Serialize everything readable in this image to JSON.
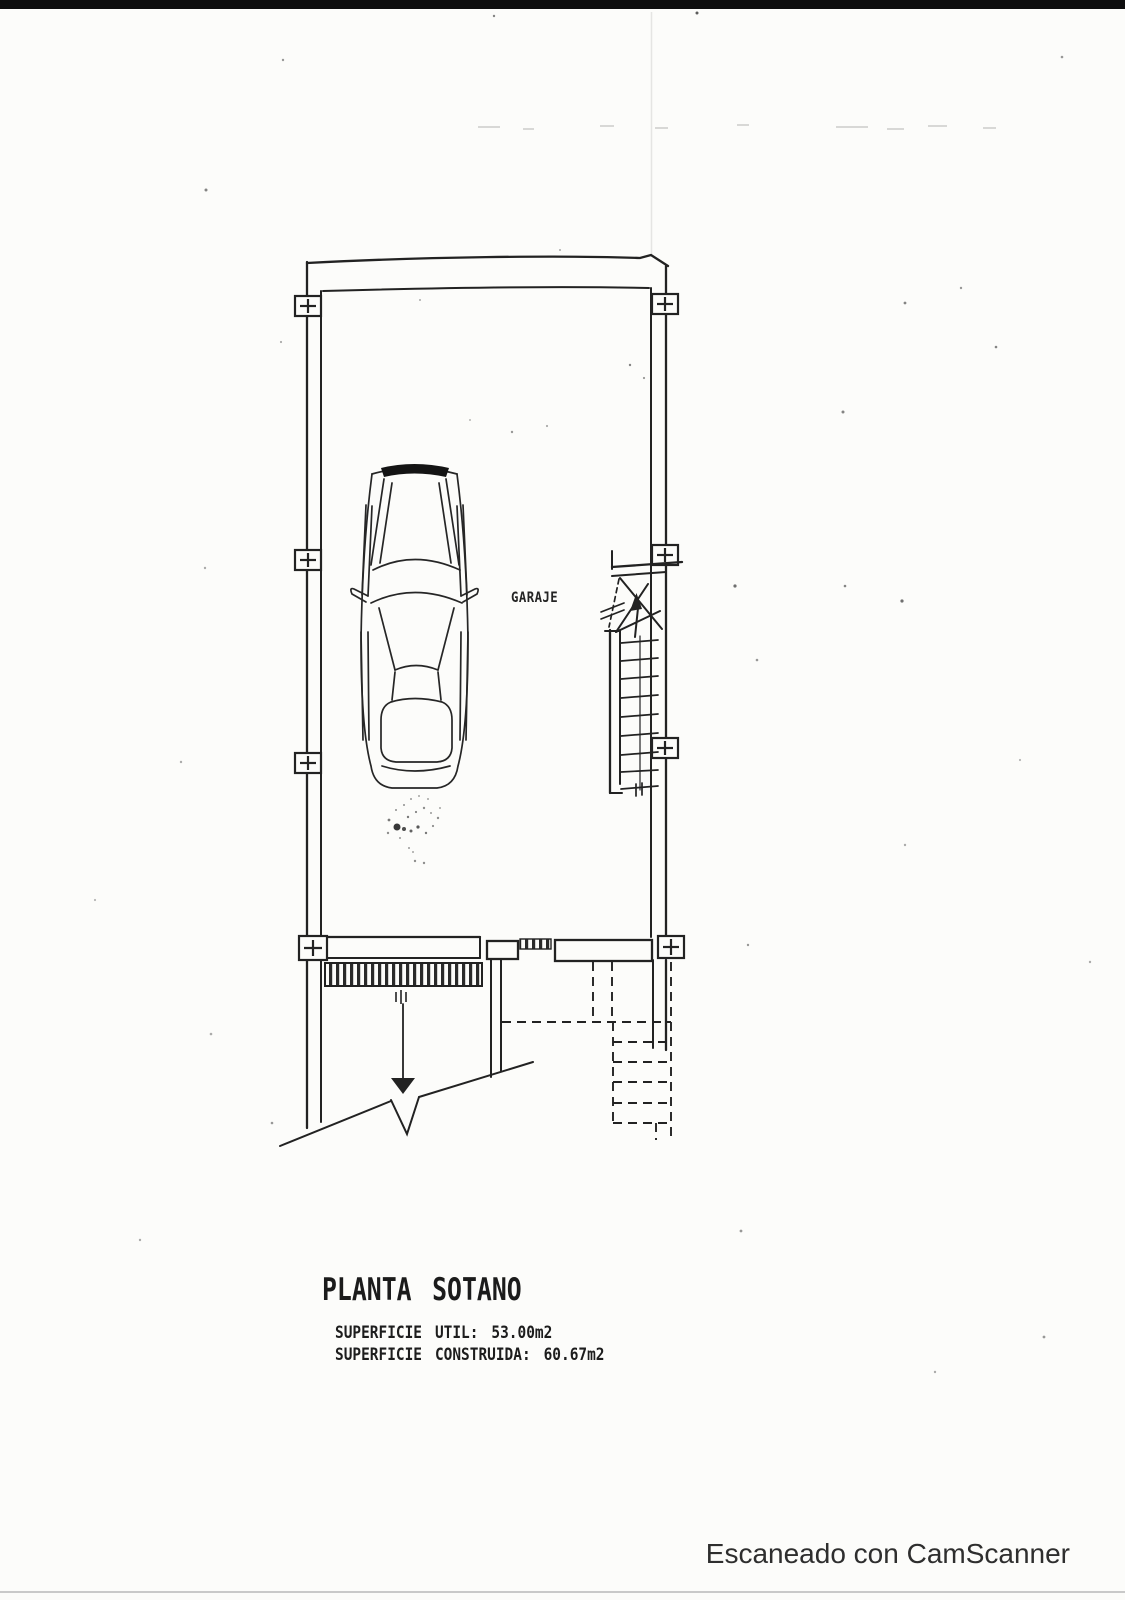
{
  "document": {
    "kind": "scanned basement floor plan",
    "background_color": "#fcfcfa",
    "ink_color": "#222222",
    "top_bar_color": "#0e0e0e",
    "bottom_rule_color": "#c9c9c9"
  },
  "plan": {
    "room_label": "GARAJE",
    "title": "PLANTA SOTANO",
    "superficie_util": "SUPERFICIE UTIL: 53.00m2",
    "superficie_construida": "SUPERFICIE CONSTRUIDA: 60.67m2"
  },
  "watermark": {
    "text": "Escaneado con CamScanner",
    "color": "#2e2e2e"
  }
}
